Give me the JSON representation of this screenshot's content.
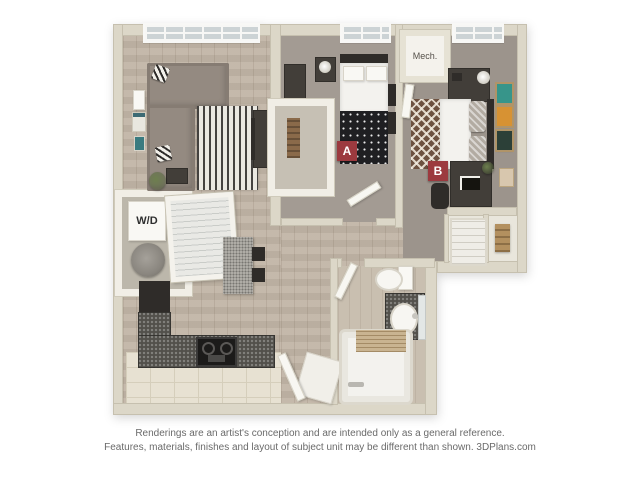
{
  "floorplan": {
    "badges": [
      {
        "id": "bedroom-a",
        "label": "A"
      },
      {
        "id": "bedroom-b",
        "label": "B"
      }
    ],
    "labels": {
      "washer_dryer": "W/D",
      "mechanical": "Mech."
    },
    "colors": {
      "background": "#ffffff",
      "badge": "#9c3a3f",
      "wall": "#dcd7c8",
      "wood_floor": "#c1b5a6",
      "carpet_a": "#a39b93",
      "carpet_b": "#9c948c",
      "kitchen_tile": "#e7e1d2",
      "counter_granite": "#52504b",
      "accent_teal_art": "#37958a",
      "accent_orange_art": "#d79233"
    }
  },
  "footer": {
    "line1": "Renderings are an artist's conception and are intended only as a general reference.",
    "line2": "Features, materials, finishes and layout of subject unit may be different than shown. 3DPlans.com"
  }
}
